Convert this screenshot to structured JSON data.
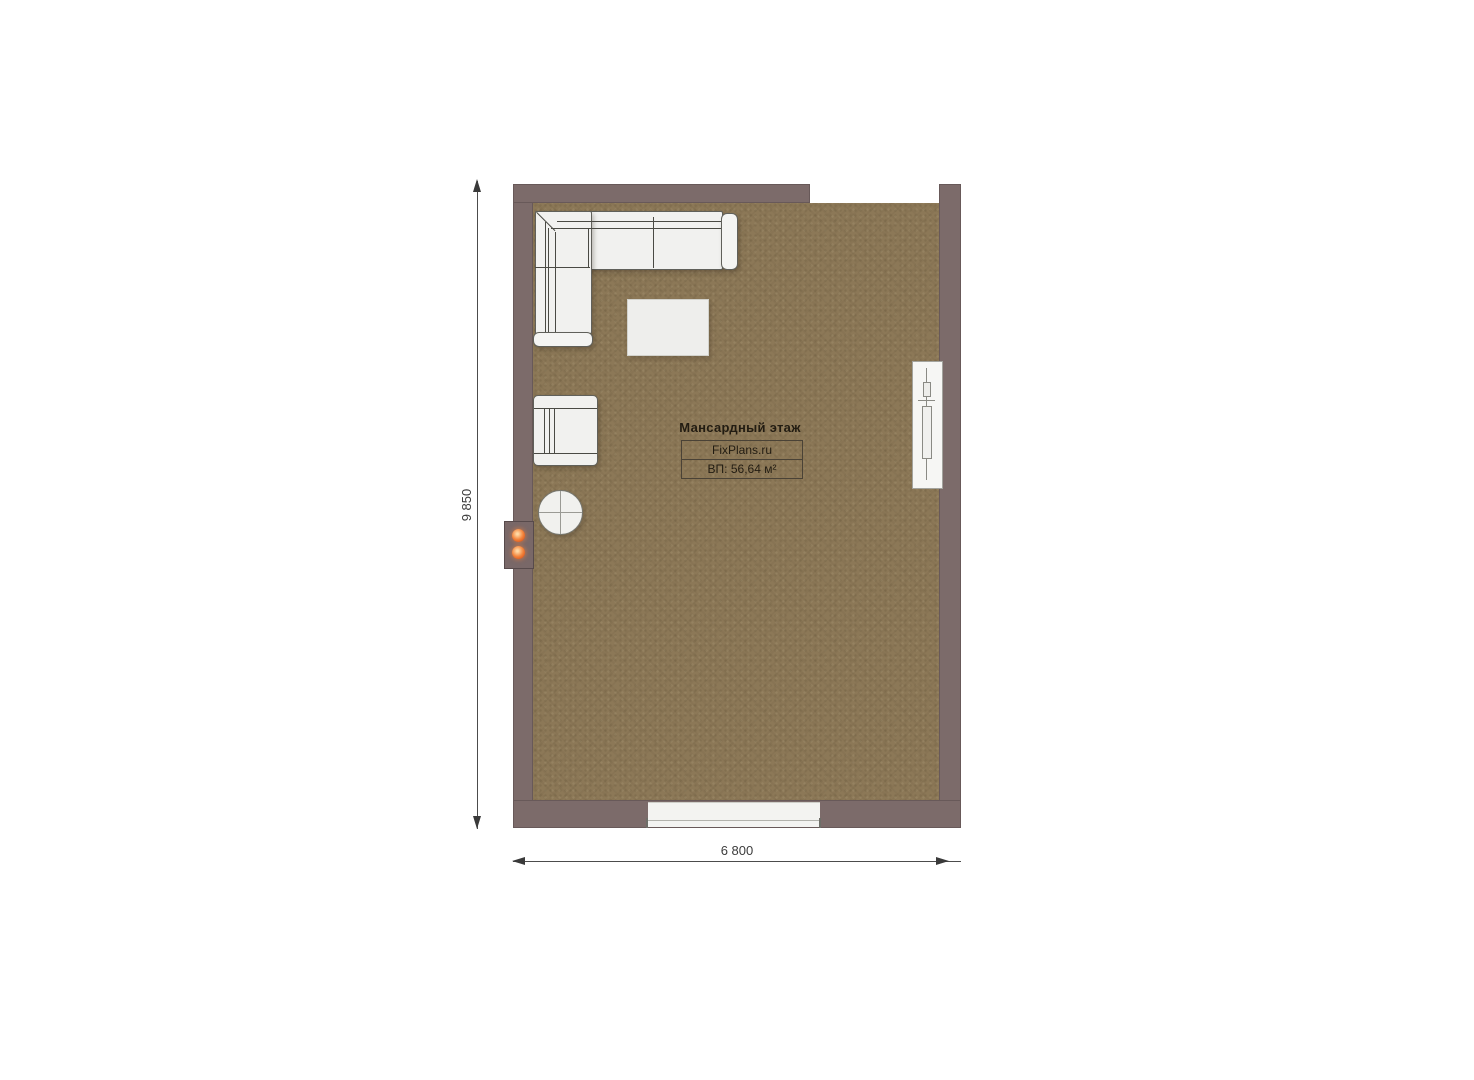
{
  "title_block": {
    "floor_label": "Мансардный этаж",
    "brand": "FixPlans.ru",
    "area": "ВП: 56,64 м²"
  },
  "dimensions": {
    "vertical_label": "9 850",
    "horizontal_label": "6 800"
  },
  "palette": {
    "wall": "#7c6b6a",
    "floor": "#8c7857",
    "furniture_fill": "#f1f1ef",
    "indicator_orange": "#f2823a",
    "dimension_text": "#3c3c3c",
    "title_text": "#221c12",
    "background": "#ffffff"
  },
  "objects": [
    "corner-sofa",
    "coffee-table",
    "armchair",
    "round-side-table",
    "heating-panel-with-indicators",
    "roof-window",
    "bottom-window",
    "top-wall-opening"
  ]
}
